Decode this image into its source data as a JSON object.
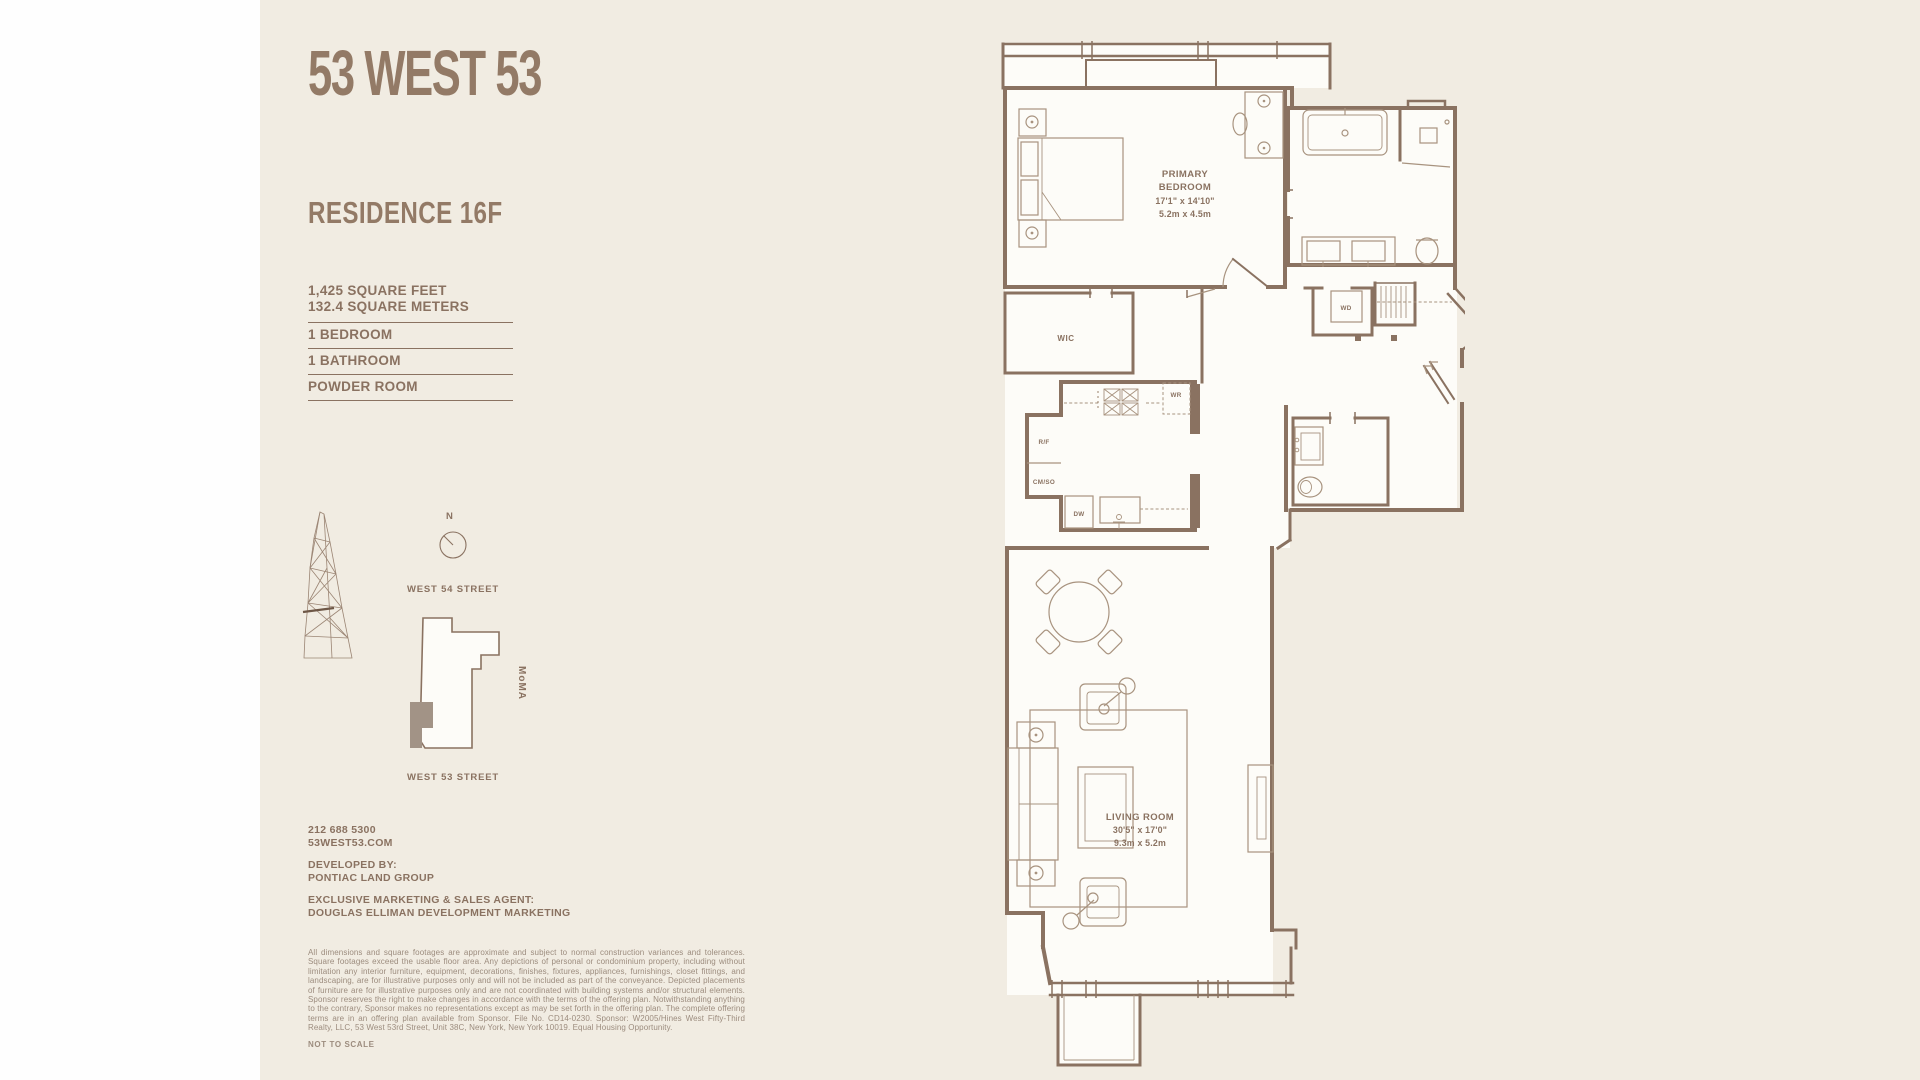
{
  "header": {
    "title": "53 WEST 53",
    "residence": "RESIDENCE 16F"
  },
  "specs": {
    "area_feet": "1,425 SQUARE FEET",
    "area_meters": "132.4 SQUARE METERS",
    "rows": [
      "1 BEDROOM",
      "1 BATHROOM",
      "POWDER ROOM"
    ]
  },
  "locator": {
    "compass": "N",
    "street_top": "WEST 54 STREET",
    "street_bottom": "WEST 53 STREET",
    "landmark": "MoMA"
  },
  "contact": {
    "phone": "212 688 5300",
    "website": "53WEST53.COM",
    "developed_by_label": "DEVELOPED BY:",
    "developer": "PONTIAC LAND GROUP",
    "agent_label": "EXCLUSIVE MARKETING & SALES AGENT:",
    "agent": "DOUGLAS ELLIMAN DEVELOPMENT MARKETING"
  },
  "legal": {
    "disclaimer": "All dimensions and square footages are approximate and subject to normal construction variances and tolerances. Square footages exceed the usable floor area. Any depictions of personal or condominium property, including without limitation any interior furniture, equipment, decorations, finishes, fixtures, appliances, furnishings, closet fittings, and landscaping, are for illustrative purposes only and will not be included as part of the conveyance. Depicted placements of furniture are for illustrative purposes only and are not coordinated with building systems and/or structural elements. Sponsor reserves the right to make changes in accordance with the terms of the offering plan. Notwithstanding anything to the contrary, Sponsor makes no representations except as may be set forth in the offering plan. The complete offering terms are in an offering plan available from Sponsor. File No. CD14-0230. Sponsor: W2005/Hines West Fifty-Third Realty, LLC, 53 West 53rd Street, Unit 38C, New York, New York 10019. Equal Housing Opportunity.",
    "not_to_scale": "NOT TO SCALE"
  },
  "floorplan": {
    "primary_bedroom": {
      "line1": "PRIMARY",
      "line2": "BEDROOM",
      "dims_ft": "17'1\" x 14'10\"",
      "dims_m": "5.2m x 4.5m"
    },
    "living_room": {
      "line1": "LIVING ROOM",
      "dims_ft": "30'5\" x 17'0\"",
      "dims_m": "9.3m x 5.2m"
    },
    "wic": "WIC",
    "wd": "WD",
    "wr": "WR",
    "rf": "R/F",
    "cmso": "CM/SO",
    "dw": "DW"
  },
  "colors": {
    "background": "#f1ece2",
    "ink": "#8a7261",
    "wall": "#8a7261",
    "furniture": "#a8937f",
    "room_fill": "#fdfcf8",
    "map_fill": "#a29386",
    "muted_text": "#9c8c7e"
  }
}
